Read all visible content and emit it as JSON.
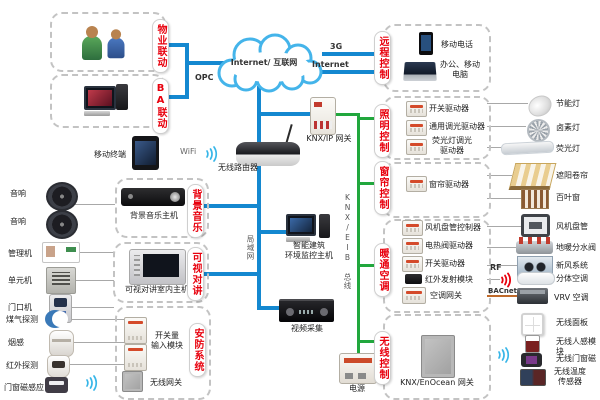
{
  "colors": {
    "line_blue": "#1488d0",
    "line_green": "#21a73d",
    "accent_red": "#e8000d",
    "line_orange": "#bf6a2a"
  },
  "cloud": {
    "label": "Internet/ 互联网"
  },
  "links": {
    "g3": "3G",
    "internet": "Internet",
    "opc": "OPC",
    "wifi": "WiFi",
    "rf": "RF",
    "bacnet": "BACnet",
    "lan": "局域网",
    "knx_bus": "KNX/EIB 总线"
  },
  "left": {
    "property_tab": "物业联动",
    "ba_tab": "BA联动",
    "speaker1": "音响",
    "speaker2": "音响",
    "manager": "管理机",
    "unit": "单元机",
    "door": "门口机",
    "gas": "煤气探测",
    "smoke": "烟感",
    "infrared": "红外探测",
    "door_magnet": "门窗磁感应"
  },
  "middle": {
    "mobile_terminal": "移动终端",
    "router": "无线路由器",
    "knx_ip_gw": "KNX/IP 网关",
    "bgm_tab": "背景音乐",
    "bgm_host": "背景音乐主机",
    "intercom_tab": "可视对讲",
    "intercom_host": "可视对讲室内主机",
    "security_tab": "安防系统",
    "switch_input": "开关量\n输入模块",
    "wireless_gw": "无线网关",
    "env_host": "智能建筑\n环境监控主机",
    "video": "视频采集",
    "power": "电源"
  },
  "right": {
    "remote_tab": "远程控制",
    "mobile_phone": "移动电话",
    "office_pc": "办公、移动\n电脑",
    "lighting_tab": "照明控制",
    "switch_driver": "开关驱动器",
    "dimmer_driver": "通用调光驱动器",
    "fl_dimmer_driver": "荧光灯调光\n驱动器",
    "curtain_tab": "窗帘控制",
    "curtain_driver": "窗帘驱动器",
    "hvac_tab": "暖通空调",
    "fcu_controller": "风机盘管控制器",
    "valve_driver": "电热阀驱动器",
    "switch_driver2": "开关驱动器",
    "ir_module": "红外发射模块",
    "ac_gateway": "空调网关",
    "wireless_tab": "无线控制",
    "enocean_gw": "KNX/EnOcean 网关"
  },
  "devices": {
    "cfl": "节能灯",
    "halogen": "卤素灯",
    "fluorescent": "荧光灯",
    "awning": "遮阳卷帘",
    "blinds": "百叶窗",
    "fan_coil": "风机盘管",
    "manifold": "地暖分水阀",
    "fresh_air": "新风系统",
    "split_ac": "分体空调",
    "vrv": "VRV 空调",
    "wl_panel": "无线面板",
    "wl_motion": "无线人感模块",
    "wl_door_magnet": "无线门窗磁",
    "wl_temp": "无线温度\n传感器"
  }
}
